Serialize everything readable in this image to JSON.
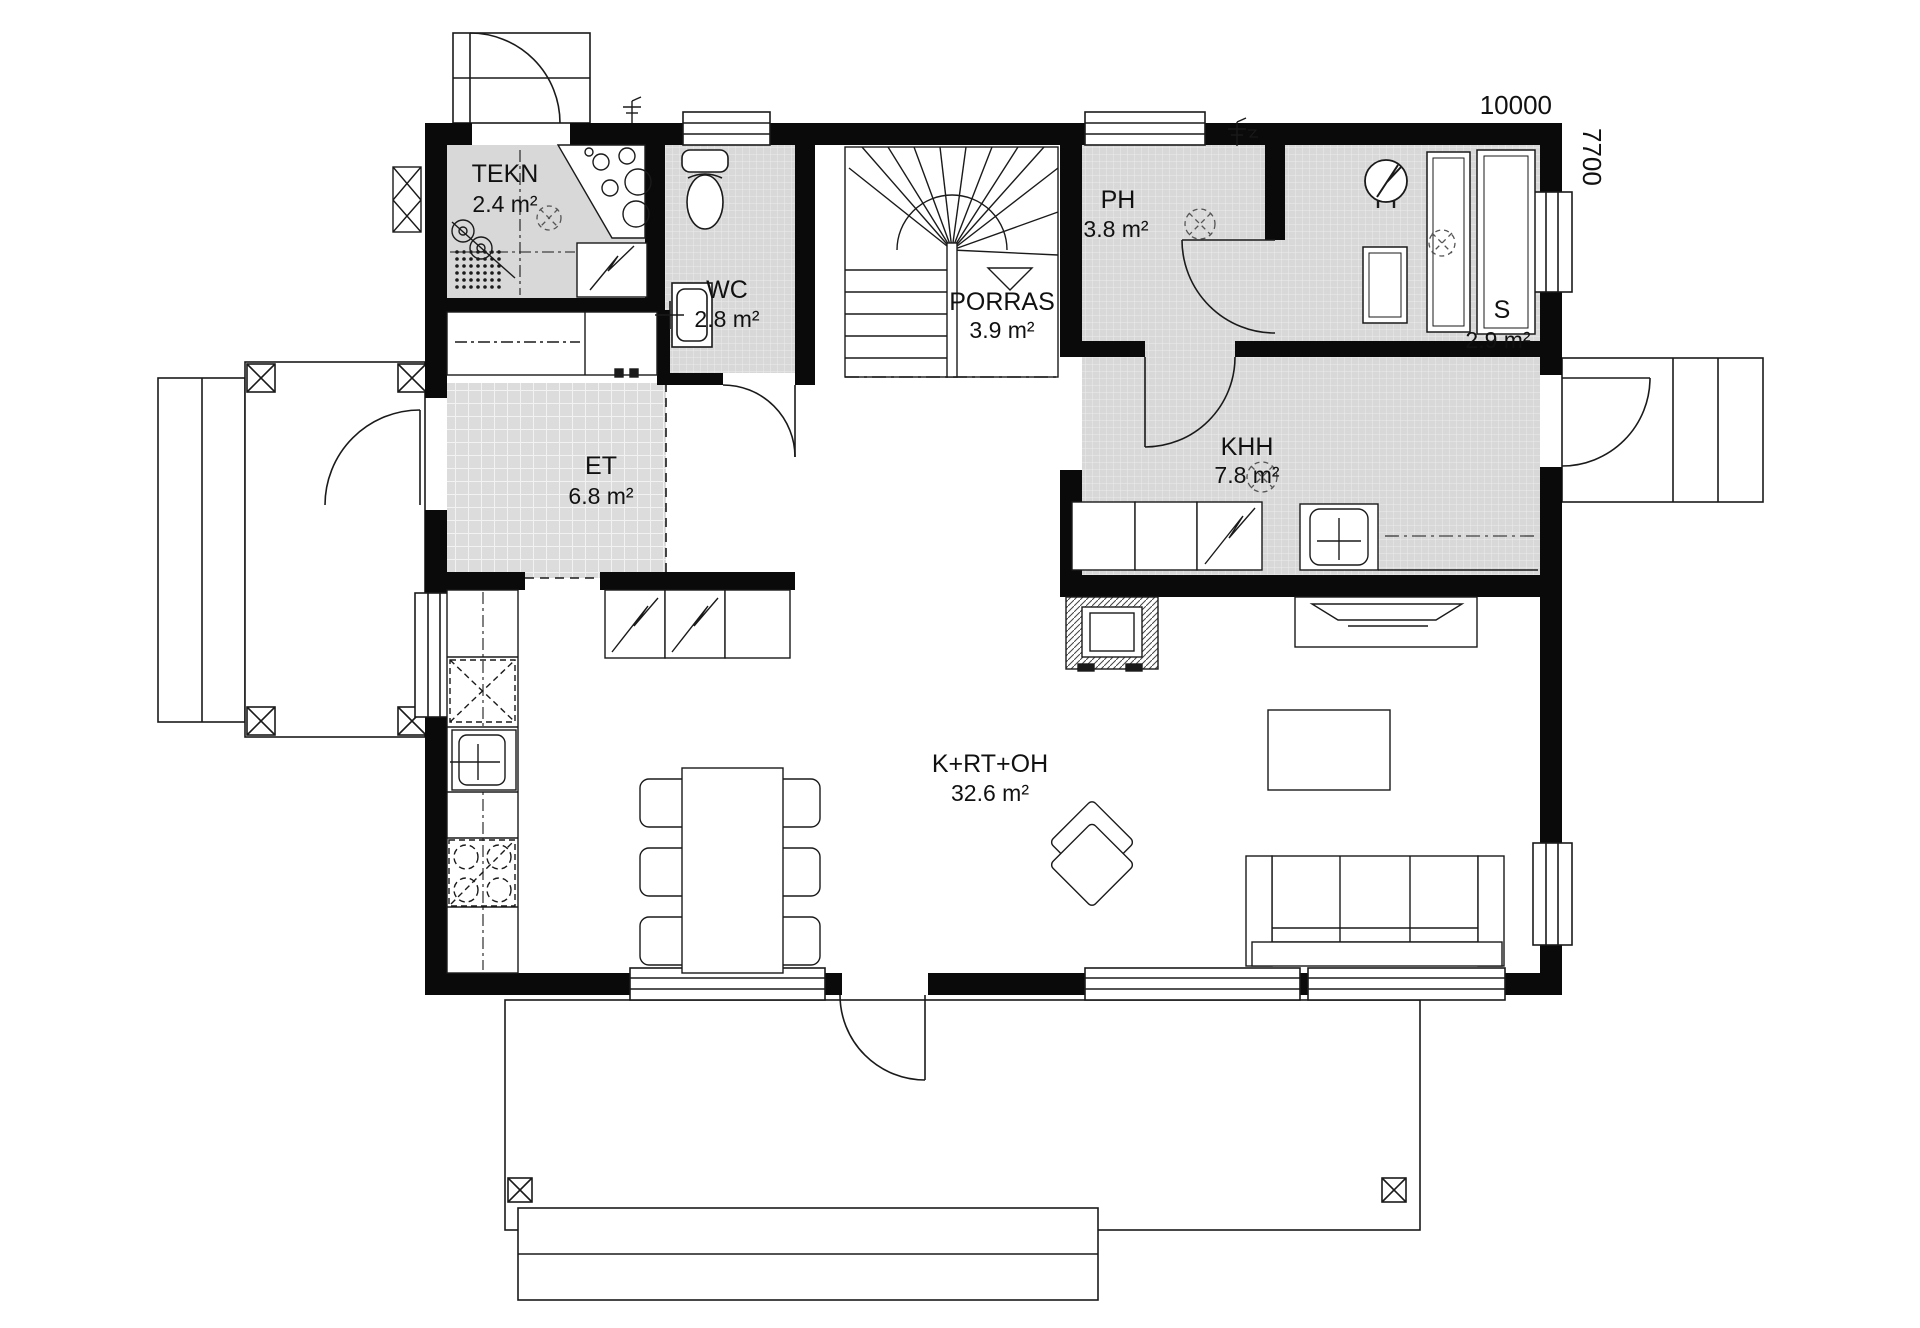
{
  "plan": {
    "dims": {
      "width": "10000",
      "height": "7700"
    },
    "rooms": [
      {
        "id": "tekn",
        "name": "TEKN",
        "area": "2.4 m²"
      },
      {
        "id": "wc",
        "name": "WC",
        "area": "2.8 m²"
      },
      {
        "id": "porras",
        "name": "PORRAS",
        "area": "3.9 m²"
      },
      {
        "id": "ph",
        "name": "PH",
        "area": "3.8 m²"
      },
      {
        "id": "s",
        "name": "S",
        "area": "2.9 m²"
      },
      {
        "id": "et",
        "name": "ET",
        "area": "6.8 m²"
      },
      {
        "id": "khh",
        "name": "KHH",
        "area": "7.8 m²"
      },
      {
        "id": "krtoh",
        "name": "K+RT+OH",
        "area": "32.6 m²"
      }
    ],
    "colors": {
      "wall": "#0a0a0a",
      "line": "#1a1a1a",
      "tile": "#d8d8d8",
      "bg": "#ffffff"
    }
  }
}
